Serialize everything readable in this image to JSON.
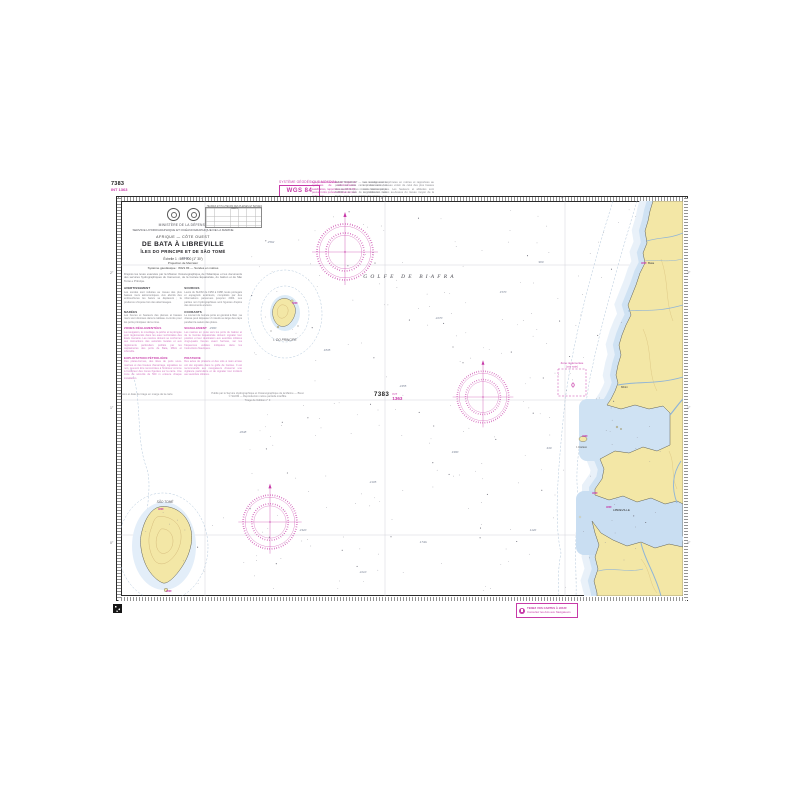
{
  "colors": {
    "magenta": "#c73aa8",
    "land": "#f3e7a6",
    "shallow_water": "#cfe2f3",
    "pale_water": "#e9f1f9",
    "depth_contour": "#9db7d0",
    "graticule": "#c9c9d2"
  },
  "corner_top_left": {
    "number": "7383",
    "int_ref": "INT 1363"
  },
  "corner_bottom_right": {
    "number": "7383",
    "int_label": "INT",
    "int_number": "1363"
  },
  "geodetic": {
    "label": "SYSTÈME GÉODÉSIQUE MONDIAL",
    "box": "WGS 84",
    "note": "Les positions relevées au moyen de systèmes de radiolocalisation satellitaires, rapportées au WGS 84, peuvent être portées directement sur cette carte."
  },
  "top_notes": {
    "left": "AVERTISSEMENT — Les renseignements portés sur cette carte proviennent des documents les plus récents détenus par le SHOM à la date de la publication. Les fonds sont susceptibles d'évolution aux abords des estuaires.",
    "right": "Les sondes sont exprimées en mètres et rapportées au zéro des cartes, niveau voisin de celui des plus basses mers astronomiques. Les hauteurs et altitudes sont exprimées en mètres au-dessus du niveau moyen de la mer."
  },
  "title_block": {
    "ministry": "MINISTÈRE DE LA DÉFENSE",
    "service": "SERVICE HYDROGRAPHIQUE ET OCÉANOGRAPHIQUE DE LA MARINE",
    "region": "AFRIQUE — CÔTE OUEST",
    "title": "DE BATA À LIBREVILLE",
    "subtitle": "ÎLES DO PRINCIPE ET DE SÃO TOMÉ",
    "scale": "Échelle 1 : 500 000 (1° 30′)",
    "projection": "Projection de Mercator",
    "datum": "Système géodésique : WGS 84 — Sondes en mètres",
    "intro": "D'après les levés exécutés par la Mission Océanographique de l'Atlantique et les documents des services hydrographiques du Cameroun, de la Guinée Équatoriale, du Gabon et de São Tomé e Príncipe.",
    "sections": [
      {
        "heading": "AVERTISSEMENT",
        "text": "Les sondes sont réduites au niveau des plus basses mers astronomiques. Aux abords des embouchures les bancs se déplacent ; la prudence s'impose lors des atterrissages."
      },
      {
        "heading": "SOURCES",
        "text": "Levés du SHOM de 1956 à 1988, levés portugais et espagnols antérieurs, complétés par des informations parvenues jusqu'en 2004. Les parties non hydrographiées sont figurées d'après des documents anciens."
      },
      {
        "heading": "MARÉES",
        "text": "Les heures et hauteurs des pleines et basses mers sont données dans le tableau ci-contre pour les ports principaux de la zone."
      },
      {
        "heading": "COURANTS",
        "text": "Le courant de Guinée porte en général à l'Est ; sa vitesse peut dépasser 2 nœuds au large des caps pendant la saison des pluies."
      }
    ],
    "regulations": [
      {
        "heading": "ZONES RÉGLEMENTÉES",
        "text": "La navigation, le mouillage, la pêche et la plongée sont réglementés dans les eaux territoriales des États riverains. Les navires doivent se conformer aux instructions des autorités locales et aux règlements particuliers publiés par les capitaineries des ports de Bata, Mbini et Libreville."
      },
      {
        "heading": "SIGNALEMENT",
        "text": "Les navires en route vers les ports du Gabon et de la Guinée Équatoriale doivent signaler leur position et leur destination aux autorités côtières vingt-quatre heures avant l'arrivée, sur les fréquences veillées indiquées dans les Instructions Nautiques."
      },
      {
        "heading": "EXPLOITATION PÉTROLIÈRE",
        "text": "Des plates-formes, des têtes de puits sous-marines et des bouées d'amarrage, signalées ou non, peuvent être rencontrées à l'intérieur comme à l'extérieur des zones figurées sur la carte. Une zone de sécurité de 500 m entoure chaque installation."
      },
      {
        "heading": "PIRATERIE",
        "text": "Des actes de piraterie et des vols à main armée ont été signalés dans le golfe de Guinée. Il est recommandé aux navigateurs d'exercer une vigilance particulière et de signaler tout incident aux autorités côtières."
      }
    ]
  },
  "tide_table": {
    "title": "HEURES ET HAUTEURS DES PLEINES ET BASSES MERS"
  },
  "map": {
    "sea_label": "GOLFE DE BIAFRA",
    "island_principe": "I. DO PRINCIPE",
    "island_sao_tome": "SÃO TOMÉ",
    "place_bata": "Bata",
    "place_mbini": "Mbini",
    "place_corisco": "I. Corisco",
    "place_libreville": "LIBREVILLE",
    "zone_label_1": "Zone réglementée",
    "zone_label_2": "(voir note)",
    "lat_labels": [
      "2°",
      "1°",
      "0°"
    ],
    "lon_labels": [
      "7°",
      "8°",
      "9°"
    ],
    "soundings": [
      {
        "x": 64,
        "y": 58,
        "v": "2410"
      },
      {
        "x": 150,
        "y": 42,
        "v": "2562"
      },
      {
        "x": 206,
        "y": 150,
        "v": "1835"
      },
      {
        "x": 318,
        "y": 118,
        "v": "2270"
      },
      {
        "x": 122,
        "y": 232,
        "v": "2648"
      },
      {
        "x": 252,
        "y": 282,
        "v": "2105"
      },
      {
        "x": 382,
        "y": 92,
        "v": "1570"
      },
      {
        "x": 334,
        "y": 252,
        "v": "1980"
      },
      {
        "x": 182,
        "y": 330,
        "v": "2320"
      },
      {
        "x": 302,
        "y": 342,
        "v": "1740"
      },
      {
        "x": 420,
        "y": 62,
        "v": "960"
      },
      {
        "x": 92,
        "y": 128,
        "v": "2980"
      },
      {
        "x": 428,
        "y": 248,
        "v": "430"
      },
      {
        "x": 242,
        "y": 372,
        "v": "2210"
      },
      {
        "x": 412,
        "y": 330,
        "v": "1120"
      },
      {
        "x": 282,
        "y": 186,
        "v": "2455"
      }
    ]
  },
  "footer": {
    "imprint_1": "Publié par le Service Hydrographique et Océanographique de la Marine — Brest",
    "imprint_2": "© SHOM — Reproduction même partielle interdite",
    "imprint_3": "Tirage de l'édition n° 3",
    "qr_caption": "Numéro et date du tirage en marge de la carte",
    "update_box_line1": "TENEZ VOS CARTES À JOUR",
    "update_box_line2": "Consultez les Avis aux Navigateurs"
  }
}
